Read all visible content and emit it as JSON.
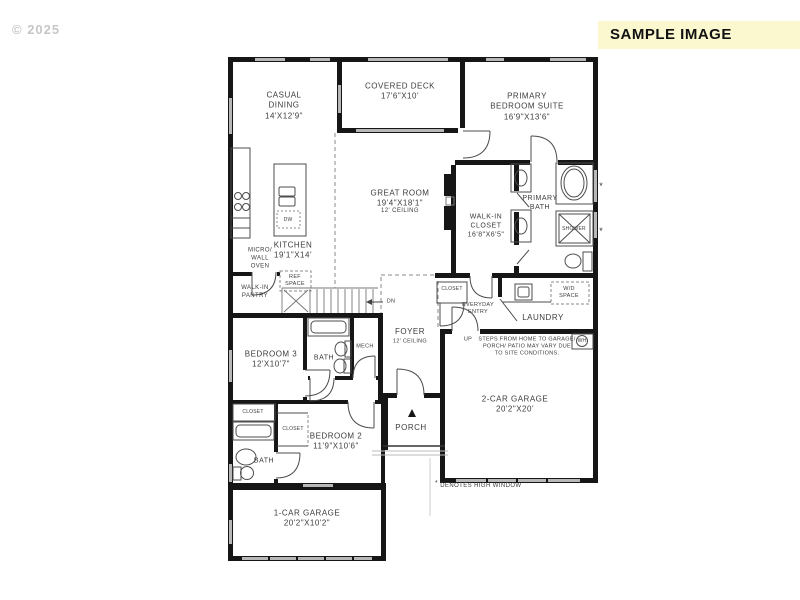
{
  "watermark": "© 2025",
  "banner": {
    "label": "SAMPLE IMAGE",
    "bg_color": "#FBF8D0",
    "text_color": "#111111"
  },
  "colors": {
    "background": "#FFFFFF",
    "wall": "#161616",
    "window": "#B8B8B8",
    "fixture_line": "#4D4D4D",
    "label_text": "#3C3C3C",
    "watermark_text": "#C7C7C7"
  },
  "plan": {
    "rooms": {
      "casual_dining": "CASUAL\nDINING\n14'X12'9\"",
      "covered_deck": "COVERED DECK\n17'6\"X10'",
      "primary_suite": "PRIMARY\nBEDROOM SUITE\n16'9\"X13'6\"",
      "great_room": "GREAT ROOM\n19'4\"X18'1\"",
      "great_room_ceiling": "12' CEILING",
      "walk_in_closet": "WALK-IN\nCLOSET\n16'8\"X6'5\"",
      "primary_bath": "PRIMARY\nBATH",
      "kitchen": "KITCHEN\n19'1\"X14'",
      "foyer": "FOYER",
      "foyer_ceiling": "12' CEILING",
      "laundry": "LAUNDRY",
      "everyday_entry": "EVERYDAY\nENTRY",
      "bedroom_3": "BEDROOM 3\n12'X10'7\"",
      "bedroom_2": "BEDROOM 2\n11'9\"X10'6\"",
      "porch": "PORCH",
      "garage_2car": "2-CAR GARAGE\n20'2\"X20'",
      "garage_1car": "1-CAR GARAGE\n20'2\"X10'2\""
    },
    "features": {
      "shower": "SHOWER",
      "micro_wall_oven": "MICRO/\nWALL\nOVEN",
      "dw": "DW",
      "ref_space": "REF\nSPACE",
      "walk_in_pantry": "WALK-IN\nPANTRY",
      "closet_entry": "CLOSET",
      "wd_space": "W/D\nSPACE",
      "wh": "WH",
      "mech": "MECH",
      "bath_upper": "BATH",
      "bath_lower": "BATH",
      "closet_bedroom3": "CLOSET",
      "closet_bedroom2": "CLOSET",
      "dn": "DN",
      "up": "UP"
    },
    "notes": {
      "steps_note": "STEPS FROM HOME TO GARAGE/\nPORCH/ PATIO MAY VARY DUE\nTO SITE CONDITIONS.",
      "high_window_asterisk": "*",
      "high_window_note": "DENOTES HIGH WINDOW"
    }
  }
}
